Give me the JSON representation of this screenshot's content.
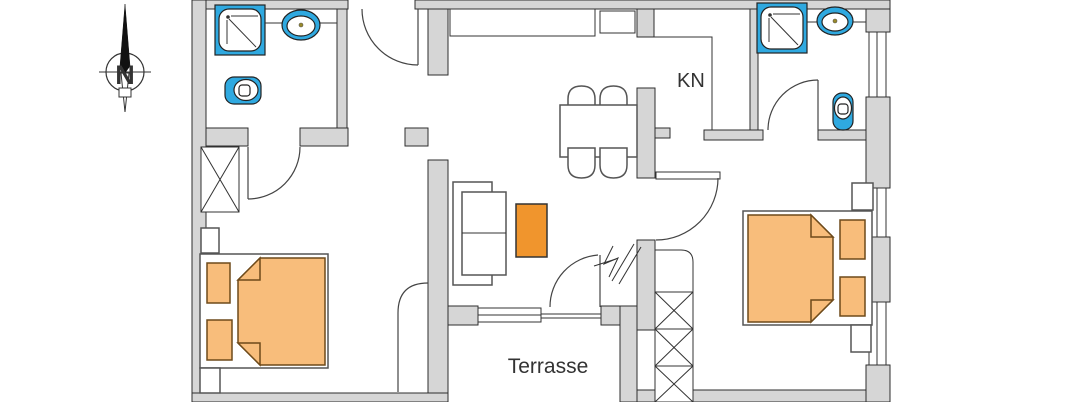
{
  "labels": {
    "north": "N",
    "kitchen": "KN",
    "terrace": "Terrasse"
  },
  "colors": {
    "wall_fill": "#d6d6d6",
    "fixture_blue": "#2fa9e0",
    "bed_orange": "#f8bd7b",
    "accent_orange": "#f0952d",
    "outline": "#333333"
  },
  "fixtures": {
    "compass": "compass-rose",
    "bathroom_left": [
      "shower",
      "washbasin",
      "toilet"
    ],
    "bathroom_right": [
      "shower",
      "washbasin",
      "toilet"
    ],
    "bedroom_left": [
      "wardrobe",
      "double-bed",
      "pillows",
      "nightstand"
    ],
    "bedroom_right": [
      "double-bed",
      "pillows",
      "nightstand"
    ],
    "living": [
      "sofa",
      "coffee-table"
    ],
    "dining": [
      "dining-table",
      "chairs"
    ],
    "kitchen": [
      "counter",
      "appliance"
    ],
    "outside": [
      "stairs",
      "sliding-window"
    ]
  }
}
